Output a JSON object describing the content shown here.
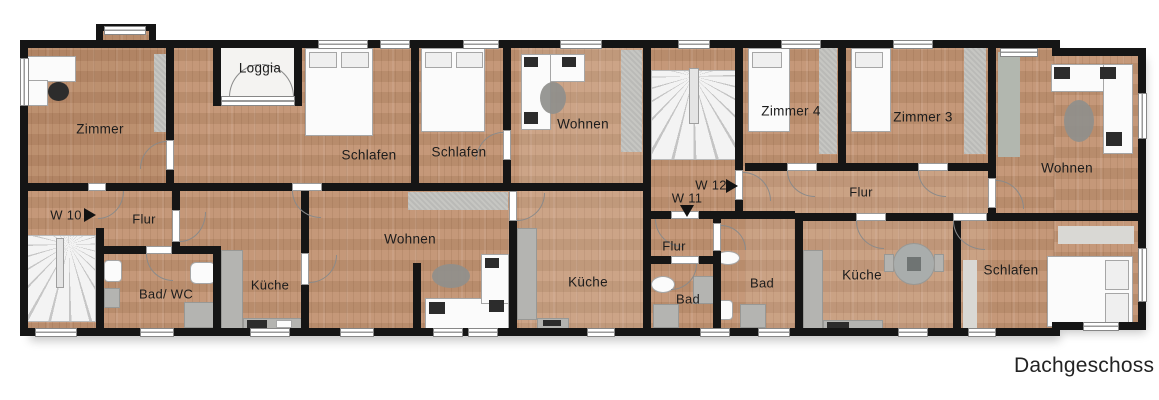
{
  "plan_title": "Dachgeschoss",
  "labels": {
    "zimmer": "Zimmer",
    "loggia": "Loggia",
    "schlafen": "Schlafen",
    "wohnen": "Wohnen",
    "zimmer4": "Zimmer 4",
    "zimmer3": "Zimmer 3",
    "flur": "Flur",
    "kueche": "Küche",
    "bad_wc": "Bad/ WC",
    "bad": "Bad",
    "w10": "W 10",
    "w11": "W 11",
    "w12": "W 12"
  },
  "colors": {
    "wall": "#151515",
    "wood_floor": "#c29372",
    "window": "#ffffff",
    "fixture_gray": "#b4b4b1",
    "stairs": "#f1f1f1",
    "text": "#1c1c1c"
  }
}
